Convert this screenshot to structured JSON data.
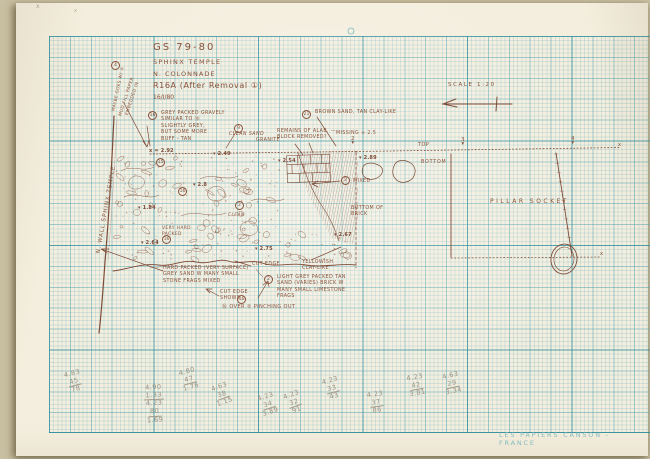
{
  "document": {
    "title_lines": [
      "GS 79-80",
      "SPHINX TEMPLE",
      "N. COLONNADE",
      "R16A  (After Removal ①)",
      "16/I/80"
    ],
    "scale_note": "SCALE  1:20",
    "paper_brand": "LES PAPIERS CANSON - FRANCE"
  },
  "colors": {
    "ink": "#8a523c",
    "pencil": "#9a9183",
    "grid_teal": "#7ab8be",
    "paper": "#f4eede"
  },
  "annotations": [
    {
      "name": "wall-label",
      "text": "N. WALL SPHINX TEMPLE",
      "x": 47,
      "y": 206,
      "w": 120,
      "rotate": -80,
      "size": 5.5,
      "ls": 1
    },
    {
      "name": "margin-note-mud-fill",
      "text": "MUD FILL PAPER\nEMBEDDED IN",
      "x": 100,
      "y": 92,
      "w": 60,
      "rotate": -72,
      "size": 4.3
    },
    {
      "name": "margin-note-maybe",
      "text": "MAYBE GOES W/ ④",
      "x": 87,
      "y": 86,
      "w": 62,
      "rotate": -78,
      "size": 4.2
    },
    {
      "name": "layer16-note",
      "text": "GREY PACKED GRAVELY\nSIMILAR TO ⑮\nSLIGHTLY GREY,\nBUT SOME MORE\nBUFF - TAN",
      "x": 161,
      "y": 111,
      "size": 4.8
    },
    {
      "name": "clean-sand-note",
      "text": "CLEAN SAND",
      "x": 229,
      "y": 132,
      "size": 4.8,
      "italic": true
    },
    {
      "name": "granite-note",
      "text": "GRANITE",
      "x": 256,
      "y": 138,
      "size": 4.8
    },
    {
      "name": "remains-note",
      "text": "REMAINS OF ALAB. —\nBLOCK REMOVED?",
      "x": 277,
      "y": 129,
      "size": 4.8
    },
    {
      "name": "layer21-note",
      "text": "BROWN SAND, TAN CLAY-LIKE",
      "x": 315,
      "y": 110,
      "size": 4.8
    },
    {
      "name": "missing-note",
      "text": "MISSING ≈ 2.5",
      "x": 336,
      "y": 131,
      "size": 4.8
    },
    {
      "name": "datum-point-2",
      "text": "2\n▾",
      "x": 349,
      "y": 137,
      "size": 5.5,
      "lh": 0.75,
      "w": 8
    },
    {
      "name": "top-label",
      "text": "TOP",
      "x": 418,
      "y": 142,
      "size": 5
    },
    {
      "name": "datum-point-3",
      "text": "3\n▾",
      "x": 459,
      "y": 138,
      "size": 5.5,
      "lh": 0.75,
      "w": 8
    },
    {
      "name": "datum-point-4",
      "text": "4\n▾",
      "x": 569,
      "y": 137,
      "size": 5.5,
      "lh": 0.75,
      "w": 8
    },
    {
      "name": "survey-x-right",
      "text": "x",
      "x": 618,
      "y": 142,
      "size": 5
    },
    {
      "name": "bottom-label",
      "text": "BOTTOM",
      "x": 421,
      "y": 160,
      "size": 4.8,
      "ls": 0.8
    },
    {
      "name": "mixed-note",
      "text": "MIXED",
      "x": 353,
      "y": 179,
      "size": 4.8
    },
    {
      "name": "bottom-of-brick-note",
      "text": "BOTTOM OF\nBRICK",
      "x": 351,
      "y": 206,
      "size": 4.8
    },
    {
      "name": "pillar-socket-label",
      "text": "PILLAR  SOCKET",
      "x": 490,
      "y": 198,
      "size": 6,
      "ls": 2.5
    },
    {
      "name": "very-hard-note",
      "text": "VERY HARD\nPACKED",
      "x": 162,
      "y": 226,
      "size": 4.4
    },
    {
      "name": "clean-note",
      "text": "CLEAN",
      "x": 228,
      "y": 213,
      "size": 4.4,
      "italic": true
    },
    {
      "name": "hard-packed-note",
      "text": "HARD PACKED (VERY SURFACE)\nGREY SAND W MANY SMALL\nSTONE FRAGS MIXED",
      "x": 163,
      "y": 266,
      "size": 4.8
    },
    {
      "name": "cut-edge-note",
      "text": "CUT EDGE",
      "x": 252,
      "y": 262,
      "size": 4.8
    },
    {
      "name": "yellowish-note",
      "text": "YELLOWISH\nCLAY-LIKE",
      "x": 302,
      "y": 260,
      "size": 4.8
    },
    {
      "name": "layer2-note",
      "text": "LIGHT GREY PACKED TAN\nSAND (VARIES) BRICK W\nMANY SMALL LIMESTONE\nFRAGS",
      "x": 277,
      "y": 275,
      "size": 4.8
    },
    {
      "name": "cut-edge-shows-note",
      "text": "CUT EDGE\nSHOWS",
      "x": 220,
      "y": 290,
      "size": 4.8
    },
    {
      "name": "pinching-note",
      "text": "⑯ OVER ② PINCHING OUT",
      "x": 222,
      "y": 304,
      "size": 5
    },
    {
      "name": "socket-x-mark",
      "text": "x",
      "x": 600,
      "y": 251,
      "size": 5
    },
    {
      "name": "pencil-x-1",
      "text": "x",
      "x": 36,
      "y": 3,
      "size": 6,
      "color": "#aaa295"
    },
    {
      "name": "pencil-x-2",
      "text": "x",
      "x": 74,
      "y": 8,
      "size": 5,
      "color": "#b3ab9d"
    }
  ],
  "elevations": [
    {
      "value": "x = 2.92",
      "x": 149,
      "y": 148
    },
    {
      "value": "▾ 2.49",
      "x": 213,
      "y": 151
    },
    {
      "value": "▾ 2.54",
      "x": 278,
      "y": 158
    },
    {
      "value": "▾ 2.89",
      "x": 359,
      "y": 155
    },
    {
      "value": "▾ 2.8",
      "x": 193,
      "y": 182
    },
    {
      "value": "▾ 1.84",
      "x": 138,
      "y": 205
    },
    {
      "value": "▾ 2.64",
      "x": 141,
      "y": 240
    },
    {
      "value": "▾ 2.67",
      "x": 334,
      "y": 232
    },
    {
      "value": "▾ 2.75",
      "x": 255,
      "y": 246
    }
  ],
  "circled_numbers": [
    {
      "value": "4",
      "x": 111,
      "y": 61
    },
    {
      "value": "16",
      "x": 148,
      "y": 111
    },
    {
      "value": "15",
      "x": 156,
      "y": 158
    },
    {
      "value": "9",
      "x": 234,
      "y": 124
    },
    {
      "value": "21",
      "x": 302,
      "y": 110
    },
    {
      "value": "16",
      "x": 178,
      "y": 187
    },
    {
      "value": "2",
      "x": 235,
      "y": 201
    },
    {
      "value": "16",
      "x": 162,
      "y": 235
    },
    {
      "value": "2",
      "x": 341,
      "y": 176
    },
    {
      "value": "2",
      "x": 264,
      "y": 275
    },
    {
      "value": "16",
      "x": 237,
      "y": 295
    }
  ],
  "pencil_calcs": [
    {
      "x": 64,
      "y": 370,
      "rotate": -14,
      "lines": [
        "4.83",
        "45",
        "78"
      ]
    },
    {
      "x": 144,
      "y": 384,
      "rotate": -3,
      "lines": [
        "4.90",
        "1.33",
        "4.23",
        "80",
        "1.69"
      ]
    },
    {
      "x": 179,
      "y": 368,
      "rotate": -15,
      "lines": [
        "4.80",
        "47",
        "1.76"
      ]
    },
    {
      "x": 212,
      "y": 383,
      "rotate": -20,
      "lines": [
        "4.63",
        "38",
        "1.15"
      ]
    },
    {
      "x": 258,
      "y": 393,
      "rotate": -18,
      "lines": [
        "4.23",
        "34",
        "3.89"
      ]
    },
    {
      "x": 284,
      "y": 391,
      "rotate": -20,
      "lines": [
        "4.23",
        "32",
        "91"
      ]
    },
    {
      "x": 322,
      "y": 377,
      "rotate": -15,
      "lines": [
        "4.23",
        "33",
        "43"
      ]
    },
    {
      "x": 366,
      "y": 391,
      "rotate": -8,
      "lines": [
        "4.23",
        "37",
        "86"
      ]
    },
    {
      "x": 406,
      "y": 374,
      "rotate": -10,
      "lines": [
        "4.23",
        "42",
        "3.81"
      ]
    },
    {
      "x": 442,
      "y": 372,
      "rotate": -12,
      "lines": [
        "4.63",
        "29",
        "3.34"
      ]
    }
  ]
}
